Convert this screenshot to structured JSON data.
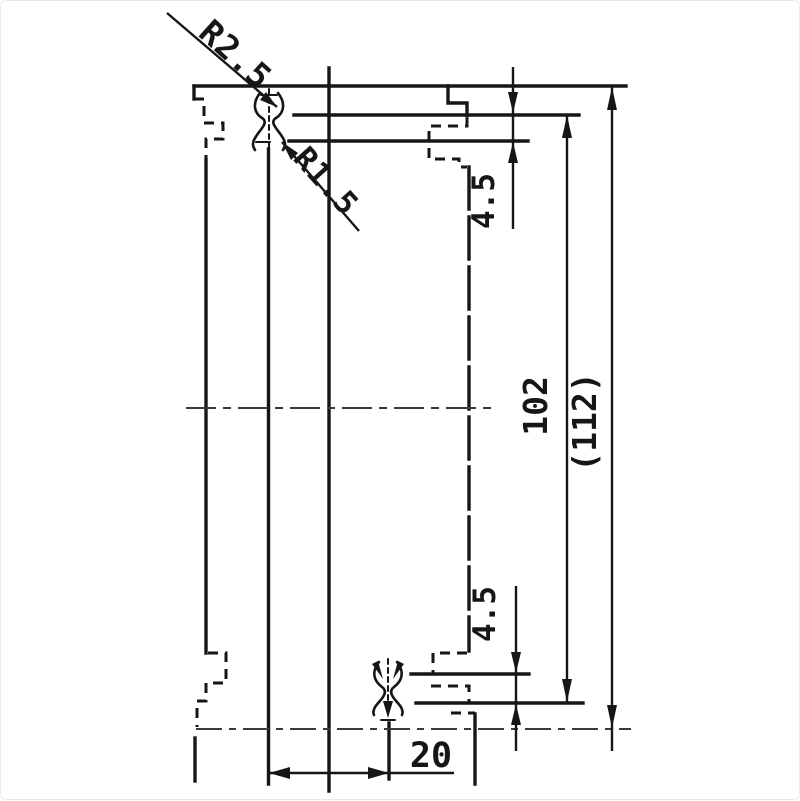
{
  "drawing": {
    "type": "engineering-dimension-drawing",
    "labels": {
      "radius_outer": "R2.5",
      "radius_inner": "R1.5",
      "step_top": "4.5",
      "step_bottom": "4.5",
      "height_inner": "102",
      "height_overall": "(112)",
      "width_bottom": "20"
    },
    "colors": {
      "ink": "#161616",
      "thin_line": "#3a3a3a",
      "paper": "#ffffff"
    }
  }
}
